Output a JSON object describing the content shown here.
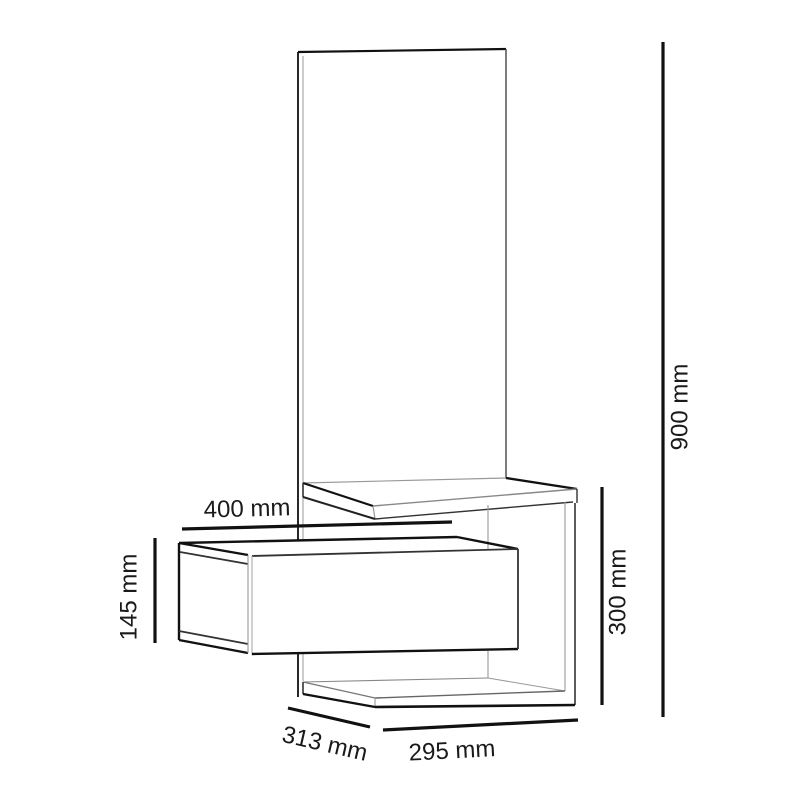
{
  "figure": {
    "type": "furniture-dimension-diagram",
    "subject": "wall-mounted hallway unit with mirror panel, shelf and drawer",
    "background": "#ffffff",
    "line_color": "#111111",
    "text_color": "#1a1a1a",
    "units": "mm",
    "labels": {
      "total_height": "900 mm",
      "drawer_width": "400 mm",
      "drawer_height": "145 mm",
      "open_section_height": "300 mm",
      "depth": "313 mm",
      "base_width": "295 mm"
    }
  }
}
